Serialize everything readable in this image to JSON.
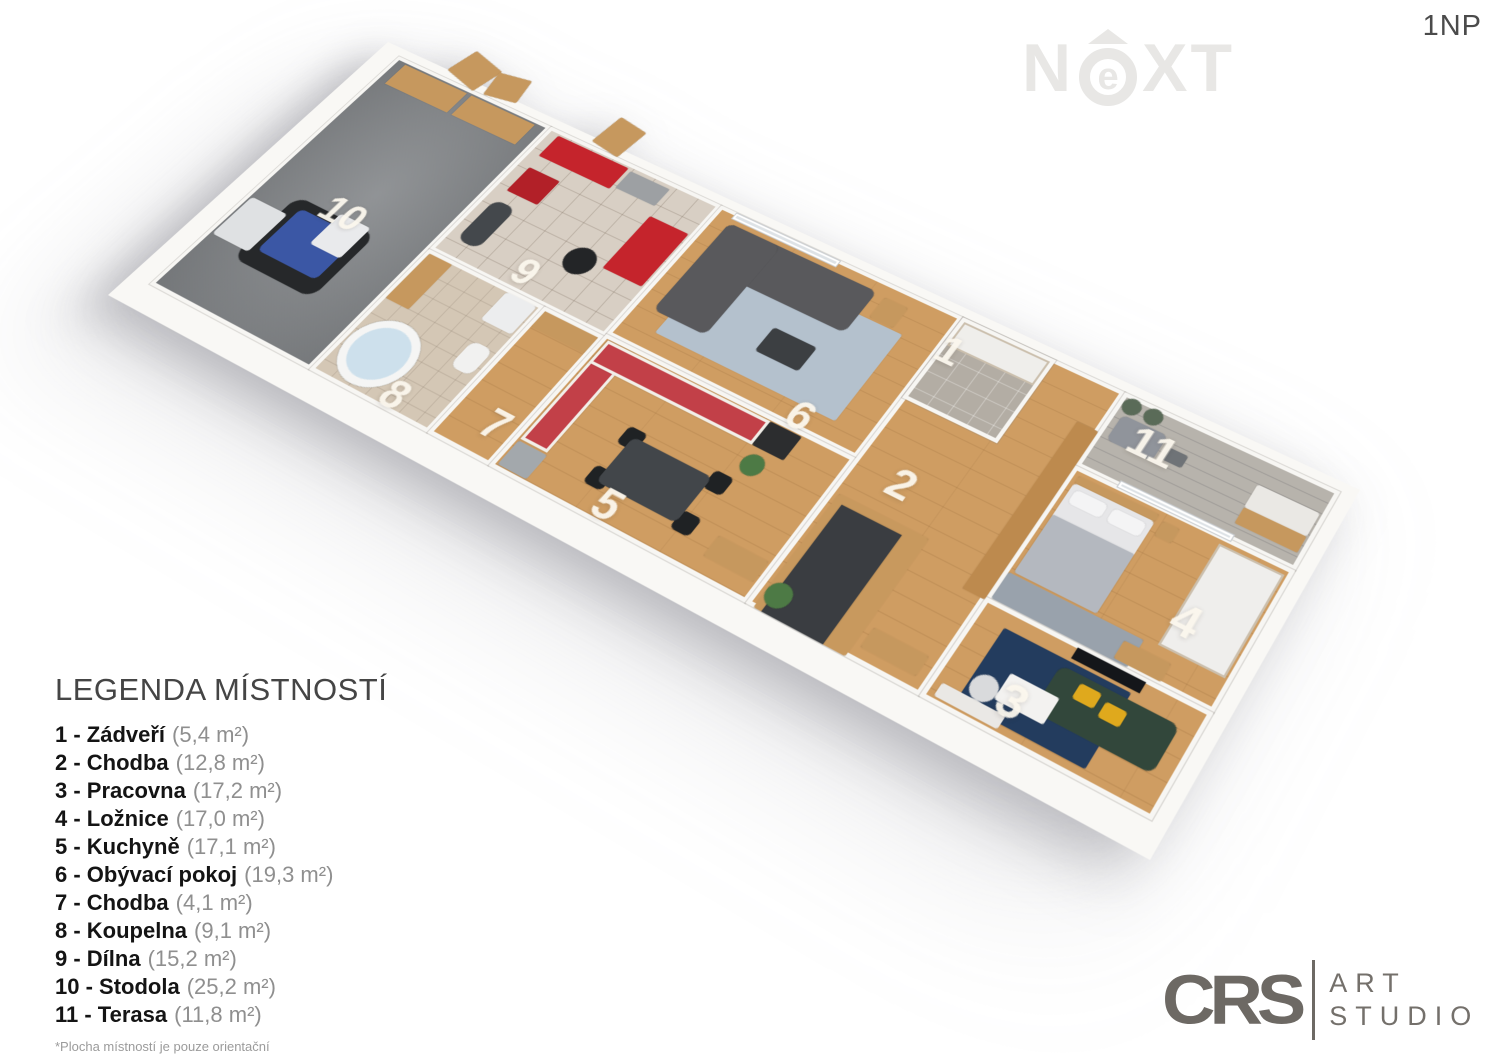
{
  "page": {
    "floor_label": "1NP"
  },
  "watermark": {
    "left": "N",
    "circle": "e",
    "right": "XT",
    "color": "#e8e7e5"
  },
  "legend": {
    "title": "LEGENDA MÍSTNOSTÍ",
    "footnote": "*Plocha místností je pouze orientační",
    "items": [
      {
        "num": "1",
        "name": "Zádveří",
        "area": "(5,4 m²)"
      },
      {
        "num": "2",
        "name": "Chodba",
        "area": "(12,8 m²)"
      },
      {
        "num": "3",
        "name": "Pracovna",
        "area": "(17,2 m²)"
      },
      {
        "num": "4",
        "name": "Ložnice",
        "area": "(17,0 m²)"
      },
      {
        "num": "5",
        "name": "Kuchyně",
        "area": "(17,1 m²)"
      },
      {
        "num": "6",
        "name": "Obývací pokoj",
        "area": "(19,3 m²)"
      },
      {
        "num": "7",
        "name": "Chodba",
        "area": "(4,1 m²)"
      },
      {
        "num": "8",
        "name": "Koupelna",
        "area": "(9,1 m²)"
      },
      {
        "num": "9",
        "name": "Dílna",
        "area": "(15,2 m²)"
      },
      {
        "num": "10",
        "name": "Stodola",
        "area": "(25,2 m²)"
      },
      {
        "num": "11",
        "name": "Terasa",
        "area": "(11,8 m²)"
      }
    ]
  },
  "studio_logo": {
    "brand": "CRS",
    "word1": "ART",
    "word2": "STUDIO"
  },
  "plan": {
    "colors": {
      "wall": "#f7f6f3",
      "wood_floor": "#cf9d62",
      "barn_floor": "#84878a",
      "kitchen_red": "#c24048",
      "tool_red": "#c5242c",
      "sofa_gray": "#59595c",
      "office_green": "#32473b",
      "rug_blue": "#b4c1cd",
      "rug_navy": "#233c5e",
      "pillow_yellow": "#dfa91d",
      "stair_gray": "#3a3d41",
      "tractor_blue": "#3b57a5"
    },
    "rooms": [
      {
        "id": "10-stodola",
        "x": 0,
        "y": 0,
        "w": 200,
        "h": 337,
        "cls": "concrete"
      },
      {
        "id": "9-dilna",
        "x": 200,
        "y": 0,
        "w": 210,
        "h": 178,
        "cls": "tile"
      },
      {
        "id": "8-koupelna",
        "x": 200,
        "y": 178,
        "w": 140,
        "h": 159,
        "cls": "bathfloor"
      },
      {
        "id": "7-chodba",
        "x": 340,
        "y": 178,
        "w": 70,
        "h": 159,
        "cls": "wood"
      },
      {
        "id": "6-obyvaci-pokoj",
        "x": 410,
        "y": 0,
        "w": 276,
        "h": 175,
        "cls": "wood"
      },
      {
        "id": "5-kuchyne",
        "x": 410,
        "y": 175,
        "w": 276,
        "h": 162,
        "cls": "wood"
      },
      {
        "id": "2-chodba",
        "x": 686,
        "y": 0,
        "w": 172,
        "h": 337,
        "cls": "wood"
      },
      {
        "id": "1-zadveri",
        "x": 686,
        "y": 0,
        "w": 100,
        "h": 102,
        "cls": "entryfloor"
      },
      {
        "id": "11-terasa",
        "x": 858,
        "y": 0,
        "w": 214,
        "h": 88,
        "cls": "deck"
      },
      {
        "id": "4-loznice",
        "x": 858,
        "y": 88,
        "w": 214,
        "h": 147,
        "cls": "wood"
      },
      {
        "id": "3-pracovna",
        "x": 858,
        "y": 235,
        "w": 214,
        "h": 102,
        "cls": "wood"
      }
    ],
    "furniture": [
      {
        "n": "barn-door",
        "x": 60,
        "y": -40,
        "w": 44,
        "h": 36,
        "c": "#c6985e",
        "rot": 14,
        "r": 2
      },
      {
        "n": "barn-door",
        "x": 108,
        "y": -36,
        "w": 38,
        "h": 32,
        "c": "#c6985e",
        "rot": -10,
        "r": 2
      },
      {
        "n": "workshop-door",
        "x": 250,
        "y": -42,
        "w": 36,
        "h": 40,
        "c": "#c6985e",
        "rot": 8,
        "r": 2
      },
      {
        "n": "storage-shelf",
        "x": 14,
        "y": 6,
        "w": 82,
        "h": 30,
        "c": "#c6985e",
        "cls": "boxes"
      },
      {
        "n": "storage-shelf",
        "x": 102,
        "y": 6,
        "w": 82,
        "h": 30,
        "c": "#c6985e",
        "cls": "boxes"
      },
      {
        "n": "tractor-wheels",
        "x": 44,
        "y": 190,
        "w": 100,
        "h": 86,
        "c": "#26282a",
        "r": 14
      },
      {
        "n": "tractor-body",
        "x": 58,
        "y": 200,
        "w": 74,
        "h": 58,
        "c": "#3b57a5",
        "r": 6
      },
      {
        "n": "tractor-cab",
        "x": 96,
        "y": 186,
        "w": 38,
        "h": 42,
        "c": "#e9eaec",
        "r": 4
      },
      {
        "n": "tractor-loader",
        "x": 6,
        "y": 212,
        "w": 46,
        "h": 52,
        "c": "#dfe1e3",
        "r": 4
      },
      {
        "n": "tool-cabinet",
        "x": 214,
        "y": 6,
        "w": 88,
        "h": 30,
        "c": "#c5242c",
        "r": 2
      },
      {
        "n": "workbench",
        "x": 306,
        "y": 8,
        "w": 48,
        "h": 24,
        "c": "#9da0a3",
        "r": 2
      },
      {
        "n": "tool-cart",
        "x": 216,
        "y": 52,
        "w": 38,
        "h": 34,
        "c": "#b22028",
        "r": 2
      },
      {
        "n": "tool-cabinet",
        "x": 358,
        "y": 44,
        "w": 46,
        "h": 72,
        "c": "#c5242c",
        "r": 2
      },
      {
        "n": "tires",
        "x": 318,
        "y": 104,
        "w": 32,
        "h": 32,
        "c": "#232527",
        "r": "50%"
      },
      {
        "n": "motorcycle",
        "x": 214,
        "y": 100,
        "w": 26,
        "h": 56,
        "c": "#44484c",
        "r": 10
      },
      {
        "n": "bathroom-sink",
        "x": 204,
        "y": 182,
        "w": 28,
        "h": 60,
        "c": "#c6985e",
        "r": 2
      },
      {
        "n": "washing-machine",
        "x": 298,
        "y": 182,
        "w": 36,
        "h": 36,
        "c": "#ecedee",
        "r": 3,
        "cls": "washer"
      },
      {
        "n": "toilet",
        "x": 308,
        "y": 240,
        "w": 24,
        "h": 32,
        "c": "#f1f1f0",
        "r": 8
      },
      {
        "n": "bathtub",
        "x": 206,
        "y": 256,
        "w": 74,
        "h": 74,
        "c": "#cde0ec",
        "r": "50%",
        "cls": "tub"
      },
      {
        "n": "console-table",
        "x": 344,
        "y": 182,
        "w": 62,
        "h": 20,
        "c": "#c6985e",
        "r": 2
      },
      {
        "n": "sliding-glass-door",
        "x": 428,
        "y": 0,
        "w": 120,
        "h": 7,
        "c": "#dde2e6",
        "cls": "glass"
      },
      {
        "n": "area-rug",
        "x": 448,
        "y": 44,
        "w": 200,
        "h": 108,
        "c": "#b4c1cd",
        "r": 2,
        "cls": "rugdots"
      },
      {
        "n": "corner-sofa",
        "x": 430,
        "y": 14,
        "w": 170,
        "h": 54,
        "c": "#59595c",
        "r": 8
      },
      {
        "n": "corner-sofa-chaise",
        "x": 430,
        "y": 14,
        "w": 60,
        "h": 118,
        "c": "#59595c",
        "r": 8
      },
      {
        "n": "coffee-table",
        "x": 540,
        "y": 94,
        "w": 48,
        "h": 30,
        "c": "#3c3f42",
        "r": 4
      },
      {
        "n": "side-table",
        "x": 610,
        "y": 16,
        "w": 26,
        "h": 26,
        "c": "#c6985e",
        "r": 3
      },
      {
        "n": "kitchen-counter",
        "x": 416,
        "y": 180,
        "w": 30,
        "h": 122,
        "c": "#c24048",
        "cls": "counter"
      },
      {
        "n": "kitchen-counter",
        "x": 416,
        "y": 180,
        "w": 182,
        "h": 28,
        "c": "#c24048",
        "cls": "counter"
      },
      {
        "n": "oven-column",
        "x": 598,
        "y": 180,
        "w": 34,
        "h": 28,
        "c": "#2c2d2f",
        "r": 2
      },
      {
        "n": "fridge",
        "x": 416,
        "y": 304,
        "w": 32,
        "h": 28,
        "c": "#a3a8ac",
        "r": 2
      },
      {
        "n": "dining-chair",
        "x": 492,
        "y": 244,
        "w": 20,
        "h": 20,
        "c": "#1f2224",
        "r": 5
      },
      {
        "n": "dining-chair",
        "x": 492,
        "y": 290,
        "w": 20,
        "h": 20,
        "c": "#1f2224",
        "r": 5
      },
      {
        "n": "dining-chair",
        "x": 586,
        "y": 244,
        "w": 20,
        "h": 20,
        "c": "#1f2224",
        "r": 5
      },
      {
        "n": "dining-chair",
        "x": 586,
        "y": 290,
        "w": 20,
        "h": 20,
        "c": "#1f2224",
        "r": 5
      },
      {
        "n": "dining-table",
        "x": 502,
        "y": 252,
        "w": 86,
        "h": 52,
        "c": "#42464a",
        "r": 6
      },
      {
        "n": "kitchen-sideboard",
        "x": 628,
        "y": 296,
        "w": 52,
        "h": 22,
        "c": "#c6985e",
        "r": 2
      },
      {
        "n": "plant",
        "x": 600,
        "y": 214,
        "w": 22,
        "h": 22,
        "c": "#4d7a45",
        "r": "50%"
      },
      {
        "n": "entry-wardrobe",
        "x": 690,
        "y": 4,
        "w": 92,
        "h": 30,
        "c": "#efeeeb",
        "cls": "wardrobe"
      },
      {
        "n": "stair-surround",
        "x": 694,
        "y": 212,
        "w": 92,
        "h": 125,
        "c": "#c8995e",
        "r": 2
      },
      {
        "n": "staircase",
        "x": 702,
        "y": 220,
        "w": 62,
        "h": 117,
        "c": "#3a3d41",
        "cls": "steps"
      },
      {
        "n": "plant",
        "x": 694,
        "y": 306,
        "w": 24,
        "h": 24,
        "c": "#4d7a45",
        "r": "50%"
      },
      {
        "n": "hall-sideboard",
        "x": 792,
        "y": 304,
        "w": 54,
        "h": 20,
        "c": "#c6985e",
        "r": 2
      },
      {
        "n": "tall-wardrobe",
        "x": 836,
        "y": 48,
        "w": 22,
        "h": 190,
        "c": "#bd8a4e",
        "r": 2
      },
      {
        "n": "plant",
        "x": 862,
        "y": 2,
        "w": 18,
        "h": 18,
        "c": "#5a6b58",
        "r": "50%"
      },
      {
        "n": "plant",
        "x": 884,
        "y": 2,
        "w": 18,
        "h": 18,
        "c": "#5a6b58",
        "r": "50%"
      },
      {
        "n": "lounge-sofa",
        "x": 868,
        "y": 22,
        "w": 46,
        "h": 30,
        "c": "#90949b",
        "r": 6
      },
      {
        "n": "lounge-table",
        "x": 920,
        "y": 32,
        "w": 20,
        "h": 14,
        "c": "#6f7377",
        "r": 3
      },
      {
        "n": "outdoor-counter",
        "x": 1006,
        "y": 28,
        "w": 60,
        "h": 26,
        "c": "#eae8e4",
        "r": 2
      },
      {
        "n": "outdoor-counter-wood",
        "x": 1006,
        "y": 54,
        "w": 60,
        "h": 18,
        "c": "#c6985e",
        "r": 2
      },
      {
        "n": "sliding-glass-door",
        "x": 900,
        "y": 82,
        "w": 110,
        "h": 6,
        "c": "#dde2e6",
        "cls": "glass"
      },
      {
        "n": "bed-headboard",
        "x": 866,
        "y": 96,
        "w": 80,
        "h": 8,
        "c": "#c6985e",
        "r": 2
      },
      {
        "n": "bed",
        "x": 866,
        "y": 104,
        "w": 80,
        "h": 100,
        "c": "#e6e6e8",
        "r": 4
      },
      {
        "n": "bed-blanket",
        "x": 866,
        "y": 140,
        "w": 80,
        "h": 64,
        "c": "#b4b8bf",
        "r": 2,
        "cls": "blanket"
      },
      {
        "n": "pillow",
        "x": 871,
        "y": 109,
        "w": 32,
        "h": 15,
        "c": "#f4f4f5",
        "r": 4
      },
      {
        "n": "pillow",
        "x": 909,
        "y": 109,
        "w": 32,
        "h": 15,
        "c": "#f4f4f5",
        "r": 4
      },
      {
        "n": "nightstand",
        "x": 952,
        "y": 100,
        "w": 16,
        "h": 16,
        "c": "#c6985e",
        "r": 2
      },
      {
        "n": "bedroom-rug",
        "x": 862,
        "y": 206,
        "w": 130,
        "h": 28,
        "c": "#99a2ac",
        "r": 2,
        "cls": "rugdiamond"
      },
      {
        "n": "wardrobe",
        "x": 1004,
        "y": 96,
        "w": 62,
        "h": 108,
        "c": "#efeeec",
        "cls": "wardrobe"
      },
      {
        "n": "dresser",
        "x": 978,
        "y": 214,
        "w": 44,
        "h": 18,
        "c": "#c6985e",
        "r": 2
      },
      {
        "n": "tv-screen",
        "x": 948,
        "y": 238,
        "w": 64,
        "h": 11,
        "c": "#14161a"
      },
      {
        "n": "office-rug",
        "x": 886,
        "y": 252,
        "w": 120,
        "h": 74,
        "c": "#233c5e",
        "r": 2
      },
      {
        "n": "office-sofa",
        "x": 944,
        "y": 258,
        "w": 110,
        "h": 46,
        "c": "#32473b",
        "r": 8
      },
      {
        "n": "pillow-yellow",
        "x": 966,
        "y": 264,
        "w": 20,
        "h": 15,
        "c": "#dfa91d",
        "r": 3
      },
      {
        "n": "pillow-yellow",
        "x": 992,
        "y": 268,
        "w": 20,
        "h": 15,
        "c": "#dfa91d",
        "r": 3
      },
      {
        "n": "coffee-table-white",
        "x": 912,
        "y": 284,
        "w": 46,
        "h": 26,
        "c": "#f3f2f0",
        "r": 2
      },
      {
        "n": "desk",
        "x": 868,
        "y": 318,
        "w": 60,
        "h": 13,
        "c": "#eae8e5",
        "r": 2
      },
      {
        "n": "desk-chair",
        "x": 888,
        "y": 294,
        "w": 24,
        "h": 24,
        "c": "#d9dadc",
        "r": "50%"
      }
    ],
    "labels": [
      {
        "text": "10",
        "x": 98,
        "y": 185
      },
      {
        "text": "9",
        "x": 298,
        "y": 155
      },
      {
        "text": "8",
        "x": 287,
        "y": 320
      },
      {
        "text": "7",
        "x": 387,
        "y": 301
      },
      {
        "text": "5",
        "x": 526,
        "y": 318
      },
      {
        "text": "6",
        "x": 618,
        "y": 162
      },
      {
        "text": "1",
        "x": 696,
        "y": 38
      },
      {
        "text": "2",
        "x": 736,
        "y": 178
      },
      {
        "text": "11",
        "x": 908,
        "y": 39
      },
      {
        "text": "4",
        "x": 1014,
        "y": 174
      },
      {
        "text": "3",
        "x": 926,
        "y": 305
      }
    ]
  }
}
